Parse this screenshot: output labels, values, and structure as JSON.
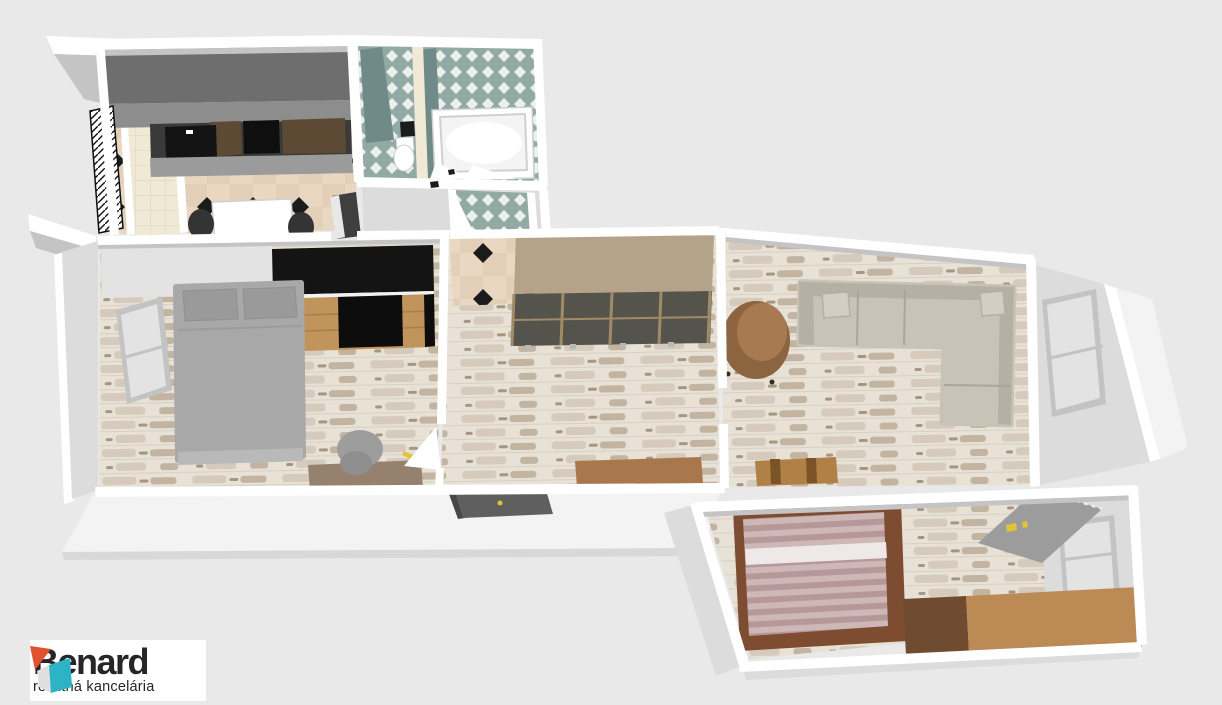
{
  "page": {
    "background": "#e9e9e9"
  },
  "logo": {
    "name": "Benard",
    "tagline": "realitná kancelária",
    "icon": "cube-icon"
  },
  "palette": {
    "page_bg": "#e9e9e9",
    "wall_top": "#ffffff",
    "wall_face": "#c4c4c4",
    "wall_face_light": "#dcdcdc",
    "exterior_face": "#f3f3f3",
    "exterior_edge": "#d8d8d8",
    "wood_base": "#e7e1d6",
    "wood_streak_a": "#d5cabb",
    "wood_streak_b": "#c2b4a0",
    "wood_dark": "#a5967f",
    "wood_line": "#d8d0c3",
    "tile_beige": "#e9d7c1",
    "tile_beige_alt": "#ddc6aa",
    "tile_diamond": "#1b1b1b",
    "bath_base": "#92a9a5",
    "bath_light": "#e9f1ea",
    "bath_wedge": "#6f8a87",
    "cream_tile": "#f0e9d6",
    "cream_line": "#ddd3b9",
    "counter_top": "#6e6e6e",
    "counter_face": "#8d8d8d",
    "counter_edge": "#9b9b9b",
    "backsplash_dark": "#3a3a3a",
    "backsplash_wood": "#5d4a35",
    "cooktop": "#0f0f0f",
    "sink_black": "#141414",
    "table_white": "#ffffff",
    "chair_dark": "#343434",
    "tub_white": "#ffffff",
    "tub_inner": "#f4f4f4",
    "fixture_line": "#d0d0d0",
    "tv_black": "#141414",
    "shelf_wood": "#c1945c",
    "shelf_line": "#a87f4a",
    "shelf_gap": "#0d0d0d",
    "cabinet_light": "#e3e3e3",
    "bed_gray": "#a8a8a8",
    "bed_gray_light": "#b9b9b9",
    "bed_fold": "#9c9c9c",
    "pillow_gray": "#9a9a9a",
    "desk_brown": "#95816e",
    "chair_gray": "#9d9d9d",
    "chair_gray_dark": "#8f8f8f",
    "wardrobe_top": "#b4a289",
    "wardrobe_front": "#54544d",
    "wardrobe_frame": "#a18a66",
    "rug_brown": "#a8774b",
    "sofa_beige": "#c7c3b6",
    "sofa_shade": "#b4b0a3",
    "sofa_seam": "#a9a598",
    "sofa_pillow": "#d2cec3",
    "sofa_shadow": "#2b2b2b",
    "armchair": "#a87a52",
    "armchair_dark": "#8d6440",
    "sideboard": "#b08046",
    "sideboard_dark": "#7a5426",
    "bed2_frame": "#7e4c31",
    "stripe_a": "#b79898",
    "stripe_b": "#cdb7b7",
    "stripe_white": "#efe8e8",
    "dresser_dark": "#6f4c2f",
    "dresser_light": "#bb8a55",
    "desk2_gray": "#9c9c9c",
    "accent_yellow": "#e4c233",
    "window_glass": "#e3e3e3",
    "window_frame": "#c3c3c3",
    "shelf_dark": "#5f5f5f",
    "shelf_dark_edge": "#474747",
    "doorway_dark": "#3f3f3f",
    "hatch_black": "#111111",
    "handle_black": "#1c1c1c",
    "logo_bg": "#ffffff",
    "logo_text": "#262626",
    "logo_orange": "#e0512e",
    "logo_teal": "#2cb4c6",
    "logo_gray": "#dfdfdf"
  }
}
